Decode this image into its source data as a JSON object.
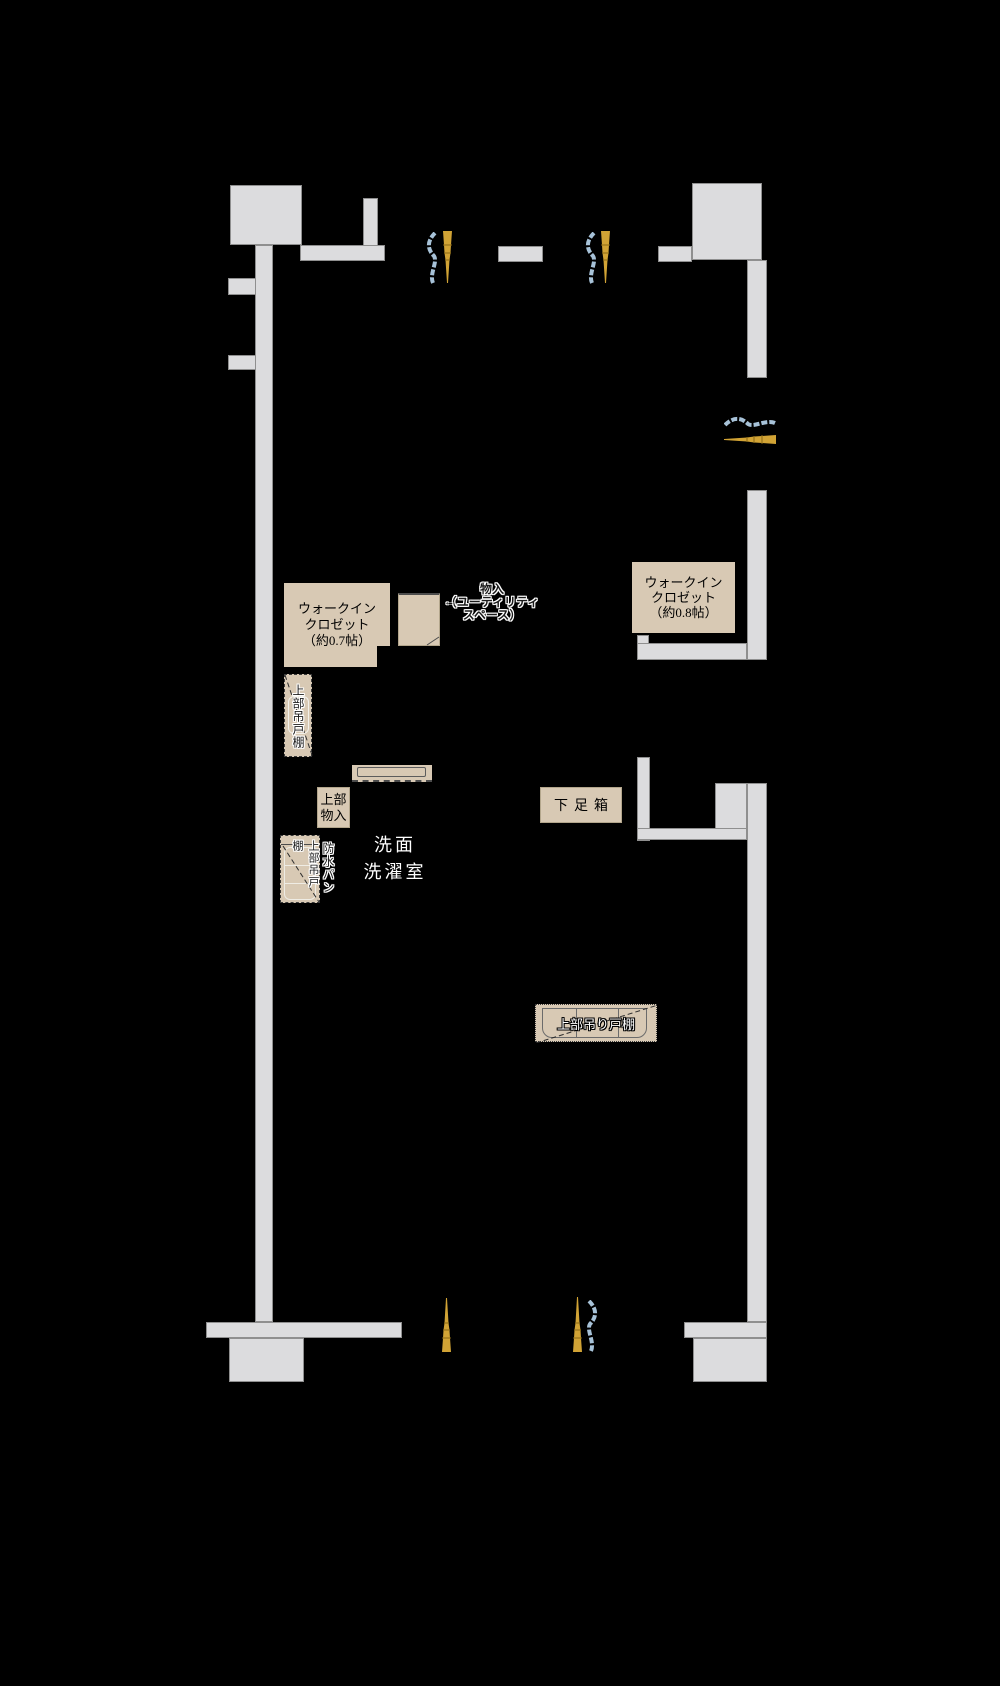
{
  "colors": {
    "background": "#000000",
    "wall": "#dcdcde",
    "wallBorder": "#8f8f8f",
    "fixture": "#d8c9b4",
    "fixtureBorder": "#b3a68c",
    "curtain": "#a7c2d8",
    "tassel": "#d1a335",
    "tasselDark": "#8a6a15",
    "ink": "#1b1b1b"
  },
  "labels": {
    "wic07": {
      "lines": [
        "ウォークイン",
        "クロゼット",
        "（約0.7帖）"
      ]
    },
    "wic08": {
      "lines": [
        "ウォークイン",
        "クロゼット",
        "（約0.8帖）"
      ]
    },
    "utility": {
      "lines": [
        "物入",
        "（ユーティリティ",
        "スペース）"
      ],
      "arrow": "←"
    },
    "upper_cabinet_1": "上部吊戸棚",
    "upper_storage": {
      "lines": [
        "上部",
        "物入"
      ]
    },
    "waterproof_pan": "防水パン",
    "pan_upper_cabinet": "上部吊戸棚",
    "washroom": {
      "lines": [
        "洗面",
        "洗濯室"
      ]
    },
    "shoe_box": "下足箱",
    "kitchen_upper_cabinet": "上部吊り戸棚"
  },
  "icons": {
    "curtain": "curtain-wave",
    "tassel": "curtain-tassel"
  }
}
